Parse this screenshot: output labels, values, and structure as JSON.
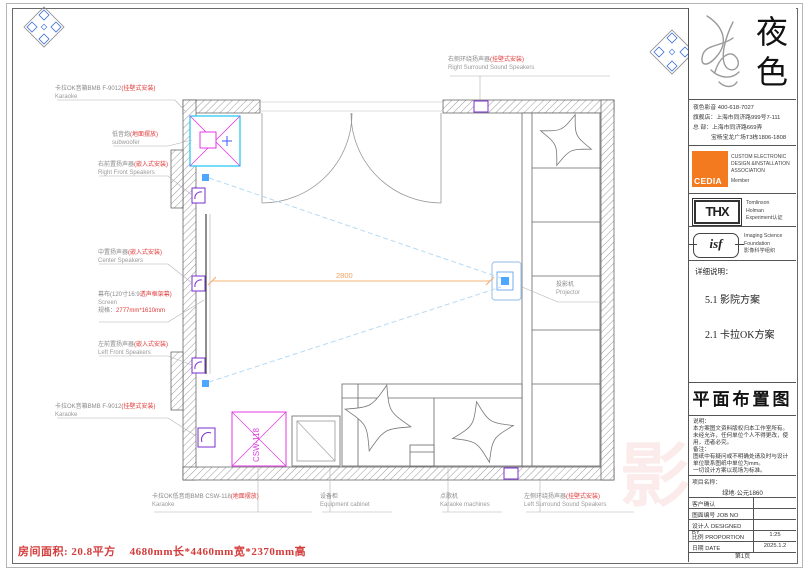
{
  "plan": {
    "dimension": "2800",
    "csw_text": "CSW-118",
    "labels": [
      {
        "cn": "卡拉OK音箱BMB F-9012",
        "red": "(挂壁式安装)",
        "en": "Karaoke"
      },
      {
        "cn": "低音炮",
        "red": "(地面摆放)",
        "en": "subwoofer"
      },
      {
        "cn": "右前置扬声器",
        "red": "(嵌入式安装)",
        "en": "Right Front Speakers"
      },
      {
        "cn": "中置扬声器",
        "red": "(嵌入式安装)",
        "en": "Center Speakers"
      },
      {
        "cn": "幕布(120寸16:9",
        "red": "透声框架幕)",
        "en": "Screen",
        "spec_label": "规格：",
        "spec_value": "2777mm*1610mm"
      },
      {
        "cn": "左前置扬声器",
        "red": "(嵌入式安装)",
        "en": "Left Front Speakers"
      },
      {
        "cn": "卡拉OK音箱BMB F-9012",
        "red": "(挂壁式安装)",
        "en": "Karaoke"
      },
      {
        "cn": "右侧环绕扬声器",
        "red": "(挂壁式安装)",
        "en": "Right Surround Sound Speakers"
      },
      {
        "cn": "卡拉OK低音炮BMB CSW-118",
        "red": "(地面摆放)",
        "en": "Karaoke"
      },
      {
        "cn": "设备柜",
        "en": "Equipment cabinet"
      },
      {
        "cn": "点歌机",
        "en": "Karaoke machines"
      },
      {
        "cn": "左侧环绕扬声器",
        "red": "(挂壁式安装)",
        "en": "Left  Surround Sound Speakers"
      },
      {
        "cn": "投影机",
        "en": "Projector"
      }
    ]
  },
  "footer": {
    "area": "房间面积: 20.8平方",
    "size": "4680mm长*4460mm宽*2370mm高"
  },
  "watermark": {
    "char1": "影",
    "char2": "音"
  },
  "panel": {
    "brand": {
      "char1": "夜",
      "char2": "色"
    },
    "contact": [
      "夜色影音  400-618-7027",
      "旗舰店：上海市同济路999号7-111",
      "总  部：上海市同济路669弄",
      "宝杨宝龙广场T3栋1806-1808"
    ],
    "cedia": {
      "logo": "CEDIA",
      "lines": [
        "CUSTOM ELECTRONIC",
        "DESIGN &INSTALLATION",
        "ASSOCIATION"
      ],
      "member": "Member"
    },
    "thx": {
      "logo": "THX",
      "lines": [
        "Tomlinson",
        "Holman",
        "Experiment认证"
      ]
    },
    "isf": {
      "logo": "isf",
      "lines": [
        "Imaging Science",
        "Foundation",
        "影像科学组织"
      ]
    },
    "details": {
      "heading": "详细说明：",
      "items": [
        "5.1 影院方案",
        "2.1 卡拉OK方案"
      ]
    },
    "sheet_title": "平面布置图",
    "notes": [
      "说明：",
      "本方案图文资料版权归本工作室所有。",
      "未经允许，任何单位个人不得更改，使",
      "用，违者必究。",
      "备注：",
      "图纸中有疑问或不明确处请及时与设计",
      "单位联系图纸中单位为mm。",
      "一切设计方案以现场为标准。"
    ],
    "table": {
      "project_label": "项目名称：",
      "project_value": "绿地·公元1860",
      "rows": [
        {
          "label": "客户确认",
          "value": ""
        },
        {
          "label": "图面编号  JOB NO",
          "value": ""
        },
        {
          "label": "设计人  DESIGNED BY",
          "value": ""
        },
        {
          "label": "比例  PROPORTION",
          "value": "1:25"
        },
        {
          "label": "日期  DATE",
          "value": "2025.1.2"
        }
      ],
      "page": "第1页"
    }
  }
}
